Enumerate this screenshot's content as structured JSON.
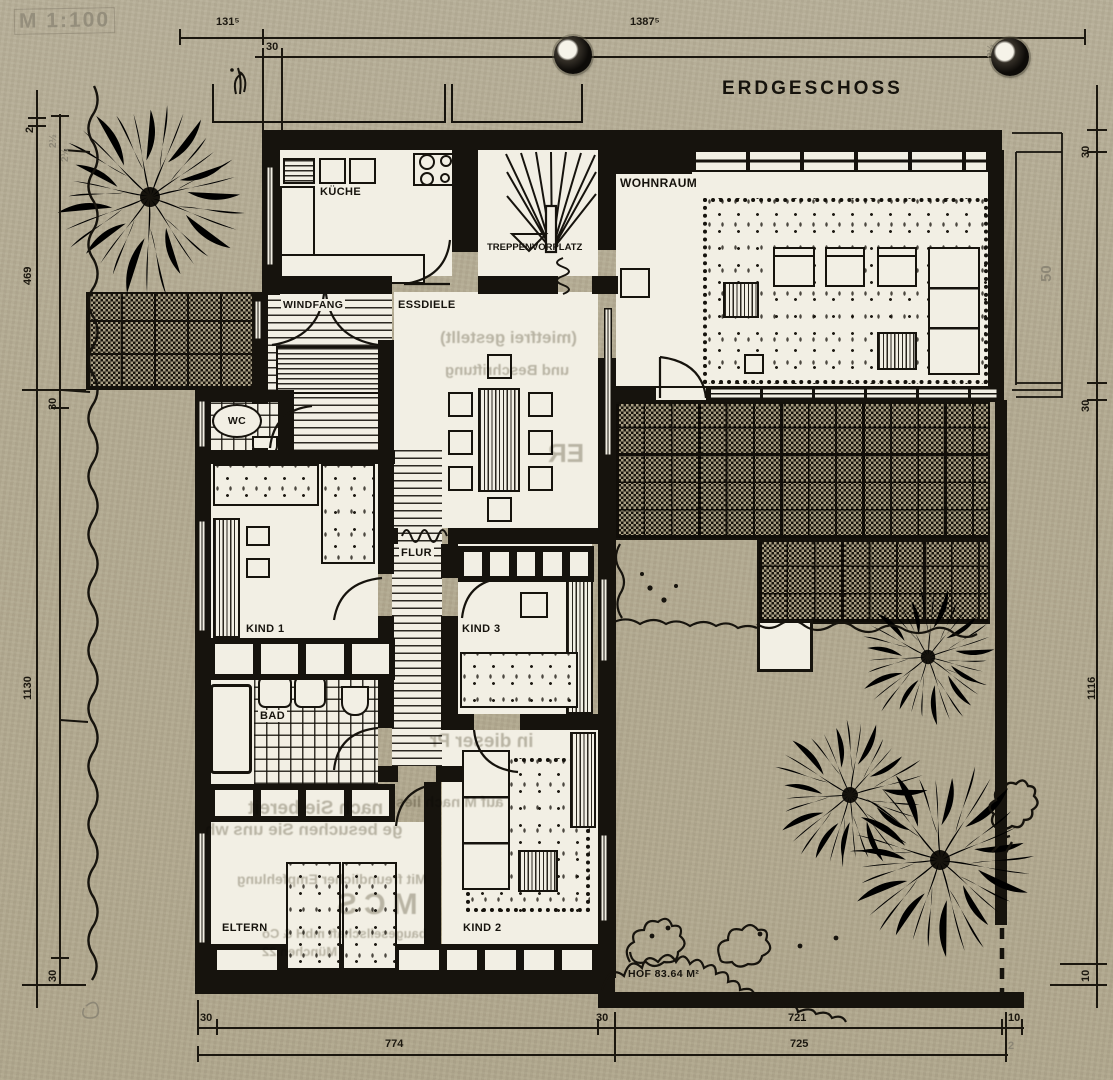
{
  "drawing": {
    "title": "ERDGESCHOSS",
    "scale_note": "M 1:100"
  },
  "rooms": {
    "kueche": "KÜCHE",
    "treppenvorplatz": "TREPPENVORPLATZ",
    "wohnraum": "WOHNRAUM",
    "windfang": "WINDFANG",
    "essdiele": "ESSDIELE",
    "wc": "WC",
    "flur": "FLUR",
    "kind1": "KIND 1",
    "kind3": "KIND 3",
    "bad": "BAD",
    "eltern": "ELTERN",
    "kind2": "KIND 2"
  },
  "court": {
    "hof_label": "HOF 83.64 M²"
  },
  "dims": {
    "top": {
      "a": "131⁵",
      "b": "1387⁵",
      "c": "30",
      "pencil": "2½"
    },
    "left": {
      "a": "2",
      "b": "2½",
      "c": "2½",
      "d": "469",
      "e": "30",
      "f": "1130",
      "g": "30"
    },
    "right": {
      "a": "30",
      "b": "50",
      "c": "30",
      "d": "1116",
      "e": "10"
    },
    "bottom": {
      "a": "30",
      "b": "774",
      "c": "30",
      "d": "721",
      "e": "10",
      "f": "725",
      "g": "2"
    }
  },
  "ghost_text": {
    "a": "(mietfrei gestellt)",
    "b": "und Beschriftung",
    "c": "ER",
    "d": "in dieser Pr",
    "e": "auf M nach lies",
    "f": "nach Sie bereit",
    "g": "ge besuchen Sie uns wh",
    "h": "Mit freundlicher Empfehlung",
    "i": "MCS",
    "j": "baugesellschaft mbH & Co",
    "k": "München 22"
  },
  "colors": {
    "paper": "#b4ab92",
    "ink": "#16130d",
    "floor": "#f2efe4",
    "pencil": "#8d8776"
  }
}
